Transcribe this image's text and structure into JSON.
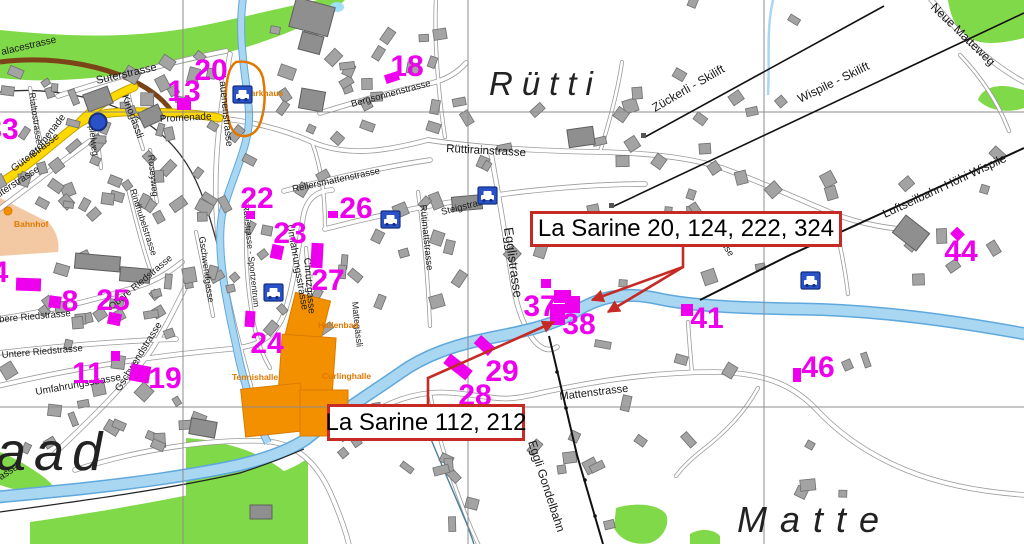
{
  "annotations": {
    "box1": {
      "text": "La Sarine 20, 124, 222, 324",
      "x": 530,
      "y": 211,
      "w": 306,
      "h": 30
    },
    "box2": {
      "text": "La Sarine 112, 212",
      "x": 327,
      "y": 404,
      "w": 192,
      "h": 31
    }
  },
  "leaders": [
    "M683,245 L683,267 L592,300",
    "M683,267 L608,312",
    "M428,404 L428,378 L554,322"
  ],
  "numbers": [
    {
      "n": "33",
      "x": 2,
      "y": 139
    },
    {
      "n": "20",
      "x": 211,
      "y": 80
    },
    {
      "n": "13",
      "x": 184,
      "y": 101
    },
    {
      "n": "18",
      "x": 407,
      "y": 76
    },
    {
      "n": "22",
      "x": 257,
      "y": 208
    },
    {
      "n": "26",
      "x": 356,
      "y": 218
    },
    {
      "n": "23",
      "x": 290,
      "y": 243
    },
    {
      "n": "27",
      "x": 328,
      "y": 290
    },
    {
      "n": "24",
      "x": 267,
      "y": 353
    },
    {
      "n": "19",
      "x": 165,
      "y": 388
    },
    {
      "n": "8",
      "x": 70,
      "y": 311
    },
    {
      "n": "25",
      "x": 113,
      "y": 310
    },
    {
      "n": "11",
      "x": 88,
      "y": 383
    },
    {
      "n": "4",
      "x": 0,
      "y": 282
    },
    {
      "n": "37",
      "x": 540,
      "y": 316
    },
    {
      "n": "38",
      "x": 579,
      "y": 334
    },
    {
      "n": "29",
      "x": 502,
      "y": 381
    },
    {
      "n": "28",
      "x": 475,
      "y": 405
    },
    {
      "n": "41",
      "x": 707,
      "y": 328
    },
    {
      "n": "46",
      "x": 818,
      "y": 377
    },
    {
      "n": "44",
      "x": 961,
      "y": 261
    }
  ],
  "magenta_rects": [
    [
      177,
      98,
      14,
      12,
      0
    ],
    [
      385,
      73,
      14,
      9,
      -18
    ],
    [
      246,
      211,
      9,
      8,
      0
    ],
    [
      328,
      211,
      10,
      7,
      0
    ],
    [
      271,
      245,
      12,
      14,
      12
    ],
    [
      311,
      243,
      12,
      25,
      3
    ],
    [
      245,
      311,
      10,
      16,
      4
    ],
    [
      108,
      313,
      13,
      12,
      12
    ],
    [
      49,
      296,
      12,
      12,
      8
    ],
    [
      111,
      351,
      9,
      10,
      0
    ],
    [
      130,
      365,
      20,
      17,
      10
    ],
    [
      16,
      278,
      25,
      13,
      2
    ],
    [
      444,
      361,
      28,
      12,
      38
    ],
    [
      475,
      340,
      19,
      11,
      42
    ],
    [
      541,
      279,
      10,
      9,
      0
    ],
    [
      554,
      290,
      17,
      13,
      0
    ],
    [
      565,
      296,
      15,
      17,
      0
    ],
    [
      550,
      304,
      15,
      21,
      0
    ],
    [
      681,
      304,
      12,
      12,
      0
    ],
    [
      793,
      368,
      8,
      14,
      0
    ],
    [
      952,
      229,
      11,
      10,
      45
    ]
  ],
  "parking_icons": [
    [
      233,
      86
    ],
    [
      478,
      187
    ],
    [
      381,
      211
    ],
    [
      264,
      284
    ],
    [
      801,
      272
    ]
  ],
  "circle_icon": {
    "x": 98,
    "y": 122
  },
  "bahnhof_dot": {
    "x": 8,
    "y": 211
  },
  "poi_labels": [
    {
      "t": "Parkhaus",
      "x": 245,
      "y": 96
    },
    {
      "t": "Bahnhof",
      "x": 14,
      "y": 227
    },
    {
      "t": "Hallenbad",
      "x": 318,
      "y": 328
    },
    {
      "t": "Curlinghalle",
      "x": 322,
      "y": 379
    },
    {
      "t": "Tennishalle",
      "x": 232,
      "y": 380
    }
  ],
  "place_names": [
    {
      "t": "Rütti",
      "x": 489,
      "y": 95,
      "s": 33,
      "sp": 9
    },
    {
      "t": "Matte",
      "x": 737,
      "y": 532,
      "s": 36,
      "sp": 13
    },
    {
      "t": "aad",
      "x": -4,
      "y": 470,
      "s": 54,
      "sp": 8
    }
  ],
  "street_labels": [
    {
      "t": "alacestrasse",
      "x": 2,
      "y": 55,
      "r": -13,
      "s": 10
    },
    {
      "t": "Suterstrasse",
      "x": 97,
      "y": 84,
      "r": -13,
      "s": 11
    },
    {
      "t": "Promenade",
      "x": 160,
      "y": 122,
      "r": -3,
      "s": 10
    },
    {
      "t": "Promenade",
      "x": 34,
      "y": 158,
      "r": -52,
      "s": 10
    },
    {
      "t": "Kinogässli",
      "x": 122,
      "y": 96,
      "r": 70,
      "s": 10
    },
    {
      "t": "Rialtostrasse",
      "x": 29,
      "y": 93,
      "r": 82,
      "s": 9
    },
    {
      "t": "Spielweg",
      "x": 88,
      "y": 120,
      "r": 83,
      "s": 9
    },
    {
      "t": "Lauenenstrasse",
      "x": 219,
      "y": 76,
      "r": 84,
      "s": 10
    },
    {
      "t": "Güterstrasse",
      "x": 14,
      "y": 172,
      "r": -37,
      "s": 10
    },
    {
      "t": "Güterstrasse",
      "x": -8,
      "y": 202,
      "r": -33,
      "s": 10
    },
    {
      "t": "Bergsonnenstrasse",
      "x": 352,
      "y": 107,
      "r": -15,
      "s": 9.5
    },
    {
      "t": "Rüttirainstrasse",
      "x": 446,
      "y": 152,
      "r": 3,
      "s": 11.5
    },
    {
      "t": "Rellersmattenstrasse",
      "x": 293,
      "y": 192,
      "r": -12,
      "s": 9.5
    },
    {
      "t": "Steigstrasse",
      "x": 442,
      "y": 215,
      "r": -14,
      "s": 9.5
    },
    {
      "t": "Rütimattstrasse",
      "x": 420,
      "y": 205,
      "r": 84,
      "s": 9.5
    },
    {
      "t": "Egglistrasse",
      "x": 504,
      "y": 228,
      "r": 82,
      "s": 13
    },
    {
      "t": "Chrützgasse",
      "x": 304,
      "y": 258,
      "r": 85,
      "s": 10
    },
    {
      "t": "Umfahrungsstrasse",
      "x": 287,
      "y": 225,
      "r": 80,
      "s": 10
    },
    {
      "t": "Rotlistrasse - Sportzentrum",
      "x": 243,
      "y": 205,
      "r": 84,
      "s": 8.5
    },
    {
      "t": "Gschwendgasse",
      "x": 199,
      "y": 237,
      "r": 82,
      "s": 9
    },
    {
      "t": "Gschwendstrasse",
      "x": 120,
      "y": 392,
      "r": -58,
      "s": 10
    },
    {
      "t": "Gschwendstrasse",
      "x": -48,
      "y": 512,
      "r": -33,
      "s": 10
    },
    {
      "t": "Rindhubelstrasse",
      "x": 130,
      "y": 190,
      "r": 72,
      "s": 9
    },
    {
      "t": "Roseyweg",
      "x": 148,
      "y": 155,
      "r": 84,
      "s": 9
    },
    {
      "t": "Obere Riedstrasse",
      "x": -8,
      "y": 323,
      "r": -5,
      "s": 9.5
    },
    {
      "t": "Obere Riedstrasse",
      "x": 112,
      "y": 310,
      "r": -40,
      "s": 9.5
    },
    {
      "t": "Untere Riedstrasse",
      "x": 2,
      "y": 358,
      "r": -5,
      "s": 9.5
    },
    {
      "t": "Umfahrungsstrasse",
      "x": 36,
      "y": 395,
      "r": -10,
      "s": 10
    },
    {
      "t": "Mattenstrasse",
      "x": 560,
      "y": 400,
      "r": -7,
      "s": 11
    },
    {
      "t": "Rüttistrasse",
      "x": 702,
      "y": 215,
      "r": 57,
      "s": 9.5
    },
    {
      "t": "Mattegässli",
      "x": 352,
      "y": 302,
      "r": 84,
      "s": 9
    },
    {
      "t": "Zückerli - Skilift",
      "x": 655,
      "y": 112,
      "r": -30,
      "s": 12
    },
    {
      "t": "Wispile - Skilift",
      "x": 800,
      "y": 103,
      "r": -26,
      "s": 12
    },
    {
      "t": "Neue Matteweg",
      "x": 930,
      "y": 8,
      "r": 44,
      "s": 12
    },
    {
      "t": "Luftseilbahn Höhi Wispile",
      "x": 885,
      "y": 218,
      "r": -25,
      "s": 12
    },
    {
      "t": "Eggli Gondelbahn",
      "x": 528,
      "y": 442,
      "r": 72,
      "s": 12
    }
  ],
  "lifts": {
    "lines": [
      {
        "d": "M645,137 L884,6",
        "w": 1.6
      },
      {
        "d": "M612,207 L1024,13",
        "w": 1.6
      },
      {
        "d": "M700,300 L790,255 L900,205 L1024,148",
        "w": 2
      },
      {
        "d": "M549,336 L577,455 L603,544",
        "w": 2
      }
    ],
    "dots": [
      [
        557,
        372
      ],
      [
        566,
        408
      ],
      [
        585,
        480
      ],
      [
        595,
        516
      ]
    ],
    "huts": [
      [
        641,
        133
      ],
      [
        609,
        203
      ]
    ]
  },
  "railway": {
    "brown": "M0,62 C55,55 115,66 152,92 C162,99 168,106 172,112",
    "rails": "M0,92 C50,86 105,98 142,120 C168,136 188,160 200,190 C210,215 216,240 222,262"
  },
  "rivers": {
    "sarine": "M1026,334 C960,322 880,310 800,309 C740,308 690,306 655,298 C625,292 600,296 575,312 C552,326 520,332 490,338 C455,345 425,355 400,373 C370,394 340,412 305,440 C270,462 220,470 160,479 C105,487 50,492 -2,497",
    "stream": "M243,-2 C237,40 247,80 249,112 C251,145 230,180 222,215 C216,250 226,300 236,345 C244,385 255,418 268,443",
    "trickle": "M773,0 C766,30 770,60 768,95",
    "south_path": "M0,512 C80,501 170,489 240,473 C268,464 288,456 304,449",
    "bottom_stream": "M428,432 C442,466 456,498 466,522 C471,535 473,540 474,545"
  },
  "greens": [
    "M0,30 C60,36 130,40 200,26 C240,18 280,8 318,0 L345,0 C330,14 300,30 250,46 C190,64 120,78 60,80 C40,81 18,80 0,78 Z",
    "M948,0 L1024,0 L1024,38 C1000,44 980,46 966,36 C955,28 950,14 948,0 Z",
    "M978,100 C982,88 996,84 1012,87 L1024,90 L1024,108 C1010,113 990,112 978,100 Z",
    "M0,452 C15,458 32,468 45,478 C52,484 58,490 52,494 C35,495 15,490 0,485 Z",
    "M30,522 C100,512 180,498 250,482 C280,474 298,466 308,458 L308,545 L30,545 Z",
    "M186,438 C220,440 255,450 280,468 C298,482 306,500 307,520 L307,544 L186,544 Z",
    "M616,508 C636,502 658,504 666,514 C670,524 664,538 650,543 C634,546 620,540 614,528 Z",
    "M690,534 C700,528 714,529 720,536 L720,545 L690,545 Z"
  ],
  "pond": {
    "x": 337,
    "y": 7
  },
  "bahnhof_area": "M0,198 L48,222 C56,230 60,242 58,252 L0,256 Z",
  "orange_outline": "M236,62 C250,60 260,66 263,78 C266,94 265,112 259,126 C254,136 243,139 235,133 C228,126 225,108 226,90 C227,76 230,66 236,62 Z",
  "orange_buildings": [
    [
      289,
      296,
      36,
      50,
      14
    ],
    [
      280,
      336,
      54,
      62,
      4
    ],
    [
      243,
      386,
      60,
      48,
      -6
    ],
    [
      300,
      390,
      48,
      46,
      0
    ]
  ],
  "roads": {
    "yellow": [
      "M-2,184 C30,166 55,141 78,124 C95,112 120,111 150,112 C178,113 200,114 219,118",
      "M78,124 C93,108 112,96 134,87"
    ],
    "main": [
      "M230,54 C222,100 214,150 216,205 C218,255 228,305 242,355 C250,383 256,412 268,442",
      "M219,118 C255,122 285,130 312,142 C350,158 390,150 428,140",
      "M428,140 C480,148 540,151 600,152 C650,153 692,158 722,168",
      "M58,96 C110,79 170,62 226,51",
      "M320,113 C358,101 396,91 432,83 C448,79 458,72 466,63",
      "M325,229 C390,212 455,200 520,192 C565,187 610,184 645,184",
      "M284,191 C330,179 382,167 430,160",
      "M-2,386 C70,369 150,356 230,349 C262,346 276,335 284,314 C294,285 298,250 303,218 C306,199 316,191 332,190",
      "M490,148 C498,190 505,235 512,278 C516,305 522,322 532,338 C541,350 549,352 557,347",
      "M545,392 C600,380 660,372 715,372 C762,373 791,383 816,409 C841,436 872,456 906,470 C940,484 980,492 1026,495",
      "M55,453 C90,420 125,386 150,352 C164,331 175,308 185,288",
      "M-2,319 C50,311 100,299 145,284 C161,278 172,270 182,262",
      "M-2,353 C60,346 120,341 176,339",
      "M75,470 C140,449 210,439 264,441 C296,443 316,462 330,492 C341,517 346,532 349,545",
      "M545,392 C528,396 512,400 496,398 C468,395 450,391 430,393 C402,396 382,406 362,419",
      "M722,168 C762,182 800,200 832,213 C862,225 892,229 922,231",
      "M930,-2 C950,24 974,48 1000,67 C1010,74 1018,79 1026,83",
      "M-2,210 C28,188 58,164 90,141"
    ],
    "thin": [
      "M418,192 C424,235 428,280 430,326",
      "M436,-2 C434,40 438,92 445,137",
      "M128,92 C132,112 137,131 143,149",
      "M150,150 C152,170 154,186 157,202",
      "M127,184 C134,214 142,245 151,272",
      "M196,232 C202,260 208,289 213,316",
      "M247,204 C245,240 246,276 251,308 C254,330 260,351 270,368",
      "M306,248 C309,285 312,320 315,350",
      "M30,88 C33,106 36,122 40,139",
      "M95,118 C97,136 99,152 101,168",
      "M758,388 C745,412 726,432 700,452 C690,460 682,468 676,476",
      "M832,213 C840,242 845,268 848,294",
      "M960,55 C984,80 999,105 1009,131",
      "M692,372 C690,352 689,336 688,322",
      "M312,142 C322,170 325,196 325,228",
      "M600,152 C610,120 618,90 622,62",
      "M430,393 C438,440 452,480 468,521 C474,536 477,541 479,546"
    ]
  },
  "grid": {
    "vx": [
      183,
      468,
      764
    ],
    "hy": [
      112,
      407
    ]
  },
  "clusters": [
    [
      0,
      55,
      215,
      150,
      48,
      1
    ],
    [
      30,
      200,
      200,
      120,
      26,
      2
    ],
    [
      0,
      300,
      200,
      150,
      22,
      3
    ],
    [
      215,
      10,
      245,
      130,
      26,
      4
    ],
    [
      230,
      150,
      230,
      180,
      24,
      5
    ],
    [
      415,
      100,
      290,
      160,
      20,
      6
    ],
    [
      600,
      150,
      320,
      140,
      14,
      7
    ],
    [
      530,
      340,
      380,
      160,
      16,
      8
    ],
    [
      620,
      0,
      240,
      120,
      8,
      9
    ],
    [
      900,
      140,
      124,
      210,
      8,
      10
    ],
    [
      250,
      400,
      250,
      140,
      10,
      11
    ],
    [
      420,
      440,
      200,
      100,
      6,
      12
    ]
  ],
  "large_buildings": [
    [
      292,
      2,
      40,
      30,
      15
    ],
    [
      300,
      34,
      22,
      18,
      15
    ],
    [
      75,
      255,
      45,
      15,
      5
    ],
    [
      120,
      268,
      30,
      14,
      5
    ],
    [
      896,
      222,
      30,
      22,
      38
    ],
    [
      452,
      196,
      30,
      14,
      -5
    ],
    [
      568,
      128,
      26,
      18,
      -8
    ],
    [
      300,
      90,
      24,
      20,
      10
    ],
    [
      85,
      90,
      26,
      18,
      -20
    ],
    [
      140,
      108,
      22,
      16,
      -25
    ],
    [
      190,
      420,
      26,
      16,
      10
    ],
    [
      250,
      505,
      22,
      14,
      0
    ]
  ],
  "colors": {
    "green": "#80D948",
    "road_casing": "#9B9B9B",
    "road_fill": "#FFFFFF",
    "yellow": "#FFD900",
    "yellow_casing": "#C7A300",
    "river_fill": "#A9D7F2",
    "river_edge": "#5FA8DC",
    "building": "#A3A3A3",
    "building_stroke": "#6F6F6F",
    "orange": "#F39000",
    "orange_stroke": "#D97B00",
    "magenta": "#EE00EE",
    "red": "#C62A24",
    "icon_blue": "#2952C8",
    "icon_blue_dark": "#16307E",
    "grid": "#8C8C8C",
    "label": "#1A1A1A",
    "poi_orange": "#E07800",
    "tan": "#F2C9A2",
    "railway_brown": "#7B4418",
    "pond": "#9FE0F7"
  }
}
